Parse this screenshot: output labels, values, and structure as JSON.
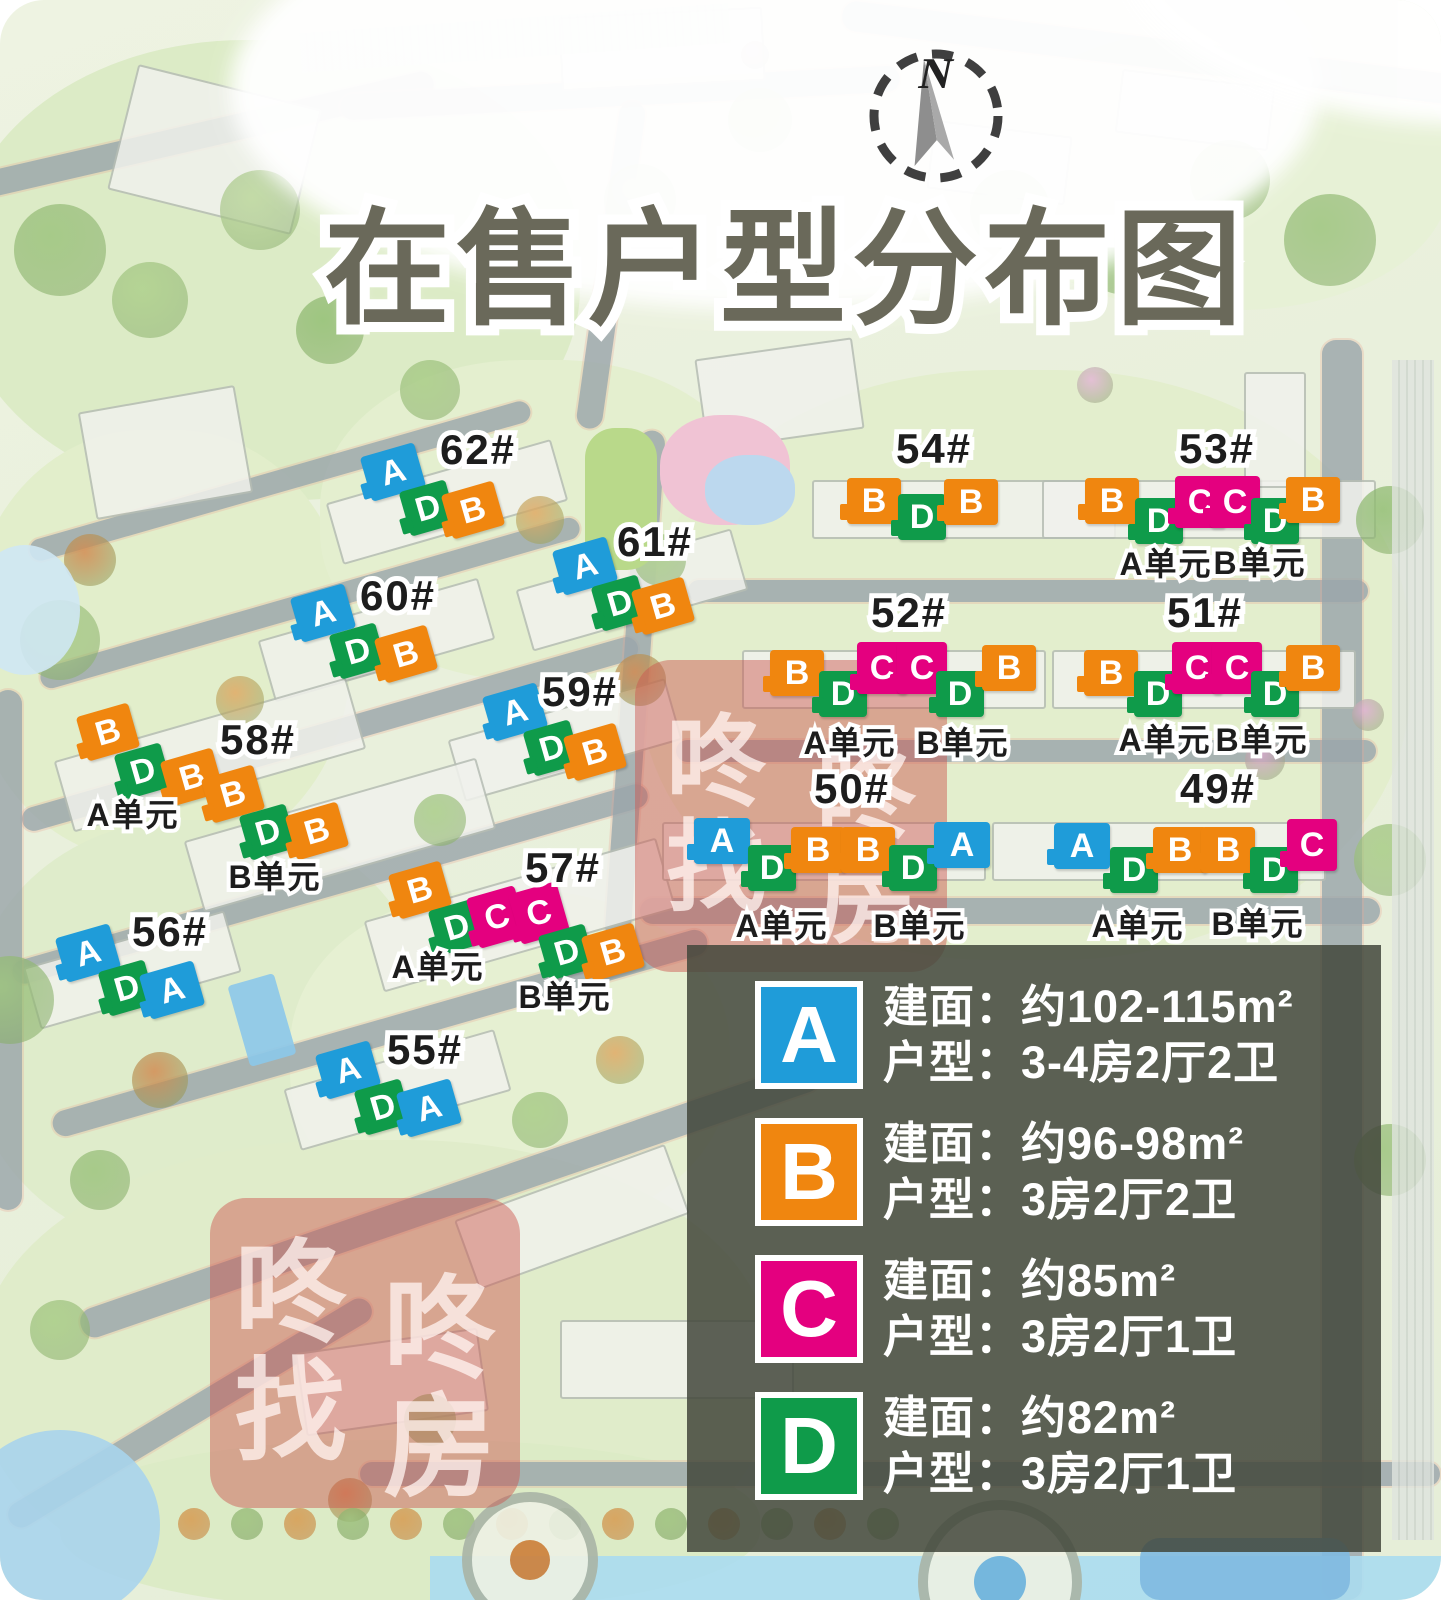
{
  "title": "在售户型分布图",
  "compass": {
    "label": "N"
  },
  "watermark": {
    "chars": [
      "咚",
      "咚",
      "找",
      "房"
    ]
  },
  "unit_colors": {
    "A": "#1f9cd9",
    "B": "#f0860f",
    "C": "#e4007f",
    "D": "#0f9b4a"
  },
  "legend": {
    "rows": [
      {
        "letter": "A",
        "color": "#1f9cd9",
        "area": "建面：约102-115m²",
        "layout": "户型：3-4房2厅2卫"
      },
      {
        "letter": "B",
        "color": "#f0860f",
        "area": "建面：约96-98m²",
        "layout": "户型：3房2厅2卫"
      },
      {
        "letter": "C",
        "color": "#e4007f",
        "area": "建面：约85m²",
        "layout": "户型：3房2厅1卫"
      },
      {
        "letter": "D",
        "color": "#0f9b4a",
        "area": "建面：约82m²",
        "layout": "户型：3房2厅1卫"
      }
    ]
  },
  "clusters": [
    {
      "label": "62#",
      "lx": 478,
      "ly": 450,
      "rot": -16,
      "markers": [
        {
          "t": "A",
          "x": 393,
          "y": 472
        },
        {
          "t": "D",
          "x": 428,
          "y": 508
        },
        {
          "t": "B",
          "x": 473,
          "y": 510
        }
      ],
      "units": []
    },
    {
      "label": "61#",
      "lx": 655,
      "ly": 542,
      "rot": -16,
      "markers": [
        {
          "t": "A",
          "x": 585,
          "y": 566
        },
        {
          "t": "D",
          "x": 620,
          "y": 603
        },
        {
          "t": "B",
          "x": 663,
          "y": 606
        }
      ],
      "units": []
    },
    {
      "label": "60#",
      "lx": 398,
      "ly": 596,
      "rot": -16,
      "markers": [
        {
          "t": "A",
          "x": 323,
          "y": 613
        },
        {
          "t": "D",
          "x": 358,
          "y": 651
        },
        {
          "t": "B",
          "x": 406,
          "y": 654
        }
      ],
      "units": []
    },
    {
      "label": "59#",
      "lx": 580,
      "ly": 692,
      "rot": -16,
      "markers": [
        {
          "t": "A",
          "x": 515,
          "y": 712
        },
        {
          "t": "D",
          "x": 552,
          "y": 748
        },
        {
          "t": "B",
          "x": 595,
          "y": 752
        }
      ],
      "units": []
    },
    {
      "label": "58#",
      "lx": 258,
      "ly": 740,
      "rot": -16,
      "markers": [
        {
          "t": "B",
          "x": 108,
          "y": 732
        },
        {
          "t": "D",
          "x": 143,
          "y": 771
        },
        {
          "t": "B",
          "x": 192,
          "y": 777
        },
        {
          "t": "B",
          "x": 233,
          "y": 794
        },
        {
          "t": "D",
          "x": 268,
          "y": 832
        },
        {
          "t": "B",
          "x": 317,
          "y": 831
        }
      ],
      "units": [
        {
          "text": "A单元",
          "x": 133,
          "y": 815
        },
        {
          "text": "B单元",
          "x": 275,
          "y": 877
        }
      ]
    },
    {
      "label": "57#",
      "lx": 563,
      "ly": 868,
      "rot": -16,
      "markers": [
        {
          "t": "B",
          "x": 420,
          "y": 890
        },
        {
          "t": "D",
          "x": 457,
          "y": 927
        },
        {
          "t": "C",
          "x": 497,
          "y": 917
        },
        {
          "t": "C",
          "x": 539,
          "y": 913
        },
        {
          "t": "D",
          "x": 567,
          "y": 952
        },
        {
          "t": "B",
          "x": 613,
          "y": 952
        }
      ],
      "units": [
        {
          "text": "A单元",
          "x": 438,
          "y": 967
        },
        {
          "text": "B单元",
          "x": 565,
          "y": 997
        }
      ]
    },
    {
      "label": "56#",
      "lx": 170,
      "ly": 932,
      "rot": -16,
      "markers": [
        {
          "t": "A",
          "x": 88,
          "y": 953
        },
        {
          "t": "D",
          "x": 127,
          "y": 988
        },
        {
          "t": "A",
          "x": 172,
          "y": 990
        }
      ],
      "units": []
    },
    {
      "label": "55#",
      "lx": 425,
      "ly": 1050,
      "rot": -16,
      "markers": [
        {
          "t": "A",
          "x": 348,
          "y": 1070
        },
        {
          "t": "D",
          "x": 383,
          "y": 1107
        },
        {
          "t": "A",
          "x": 429,
          "y": 1108
        }
      ],
      "units": []
    },
    {
      "label": "54#",
      "lx": 934,
      "ly": 449,
      "rot": 0,
      "markers": [
        {
          "t": "B",
          "x": 874,
          "y": 501
        },
        {
          "t": "D",
          "x": 922,
          "y": 517
        },
        {
          "t": "B",
          "x": 971,
          "y": 502
        }
      ],
      "units": []
    },
    {
      "label": "53#",
      "lx": 1217,
      "ly": 449,
      "rot": 0,
      "markers": [
        {
          "t": "B",
          "x": 1112,
          "y": 501
        },
        {
          "t": "D",
          "x": 1159,
          "y": 521
        },
        {
          "t": "C",
          "x": 1200,
          "y": 502
        },
        {
          "t": "C",
          "x": 1235,
          "y": 502
        },
        {
          "t": "D",
          "x": 1275,
          "y": 521
        },
        {
          "t": "B",
          "x": 1313,
          "y": 500
        }
      ],
      "units": [
        {
          "text": "A单元",
          "x": 1166,
          "y": 564
        },
        {
          "text": "B单元",
          "x": 1260,
          "y": 563
        }
      ]
    },
    {
      "label": "52#",
      "lx": 909,
      "ly": 613,
      "rot": 0,
      "markers": [
        {
          "t": "B",
          "x": 797,
          "y": 673
        },
        {
          "t": "D",
          "x": 843,
          "y": 694
        },
        {
          "t": "C",
          "x": 882,
          "y": 668
        },
        {
          "t": "C",
          "x": 922,
          "y": 668
        },
        {
          "t": "D",
          "x": 960,
          "y": 694
        },
        {
          "t": "B",
          "x": 1009,
          "y": 668
        }
      ],
      "units": [
        {
          "text": "A单元",
          "x": 850,
          "y": 743
        },
        {
          "text": "B单元",
          "x": 963,
          "y": 743
        }
      ]
    },
    {
      "label": "51#",
      "lx": 1205,
      "ly": 613,
      "rot": 0,
      "markers": [
        {
          "t": "B",
          "x": 1111,
          "y": 673
        },
        {
          "t": "D",
          "x": 1158,
          "y": 694
        },
        {
          "t": "C",
          "x": 1197,
          "y": 668
        },
        {
          "t": "C",
          "x": 1237,
          "y": 668
        },
        {
          "t": "D",
          "x": 1275,
          "y": 694
        },
        {
          "t": "B",
          "x": 1313,
          "y": 668
        }
      ],
      "units": [
        {
          "text": "A单元",
          "x": 1165,
          "y": 740
        },
        {
          "text": "B单元",
          "x": 1262,
          "y": 740
        }
      ]
    },
    {
      "label": "50#",
      "lx": 852,
      "ly": 789,
      "rot": 0,
      "markers": [
        {
          "t": "A",
          "x": 722,
          "y": 841
        },
        {
          "t": "D",
          "x": 772,
          "y": 868
        },
        {
          "t": "B",
          "x": 818,
          "y": 850
        },
        {
          "t": "B",
          "x": 868,
          "y": 850
        },
        {
          "t": "D",
          "x": 913,
          "y": 868
        },
        {
          "t": "A",
          "x": 962,
          "y": 845
        }
      ],
      "units": [
        {
          "text": "A单元",
          "x": 782,
          "y": 926
        },
        {
          "text": "B单元",
          "x": 920,
          "y": 926
        }
      ]
    },
    {
      "label": "49#",
      "lx": 1218,
      "ly": 789,
      "rot": 0,
      "markers": [
        {
          "t": "A",
          "x": 1082,
          "y": 846
        },
        {
          "t": "D",
          "x": 1134,
          "y": 870
        },
        {
          "t": "B",
          "x": 1180,
          "y": 850
        },
        {
          "t": "B",
          "x": 1228,
          "y": 850
        },
        {
          "t": "D",
          "x": 1274,
          "y": 870
        },
        {
          "t": "C",
          "x": 1312,
          "y": 845
        }
      ],
      "units": [
        {
          "text": "A单元",
          "x": 1138,
          "y": 926
        },
        {
          "text": "B单元",
          "x": 1258,
          "y": 924
        }
      ]
    }
  ]
}
